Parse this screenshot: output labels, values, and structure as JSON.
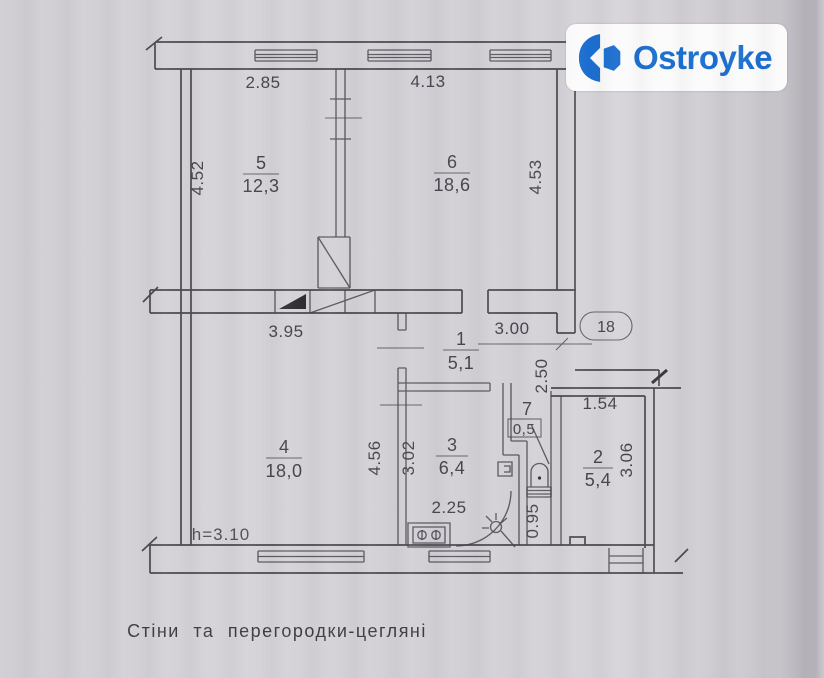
{
  "logo": {
    "text": "Ostroyke",
    "color": "#1b6ed0",
    "background": "#fbfbfb"
  },
  "apartment_number": "18",
  "caption": "Стіни та перегородки-цегляні",
  "ceiling_height": "h=3.10",
  "rooms": {
    "r1": {
      "number": "1",
      "area": "5,1"
    },
    "r2": {
      "number": "2",
      "area": "5,4"
    },
    "r3": {
      "number": "3",
      "area": "6,4"
    },
    "r4": {
      "number": "4",
      "area": "18,0"
    },
    "r5": {
      "number": "5",
      "area": "12,3"
    },
    "r6": {
      "number": "6",
      "area": "18,6"
    },
    "r7": {
      "number": "7",
      "area": "0,5"
    }
  },
  "dimensions": {
    "room5_width": "2.85",
    "room6_width": "4.13",
    "room5_height": "4.52",
    "room6_height": "4.53",
    "room4_width": "3.95",
    "hall_width": "3.00",
    "entry_depth": "2.50",
    "room2_width": "1.54",
    "room2_height": "3.06",
    "room4_height": "4.56",
    "kitchen_height": "3.02",
    "kitchen_width": "2.25",
    "wc_width": "0.95"
  }
}
